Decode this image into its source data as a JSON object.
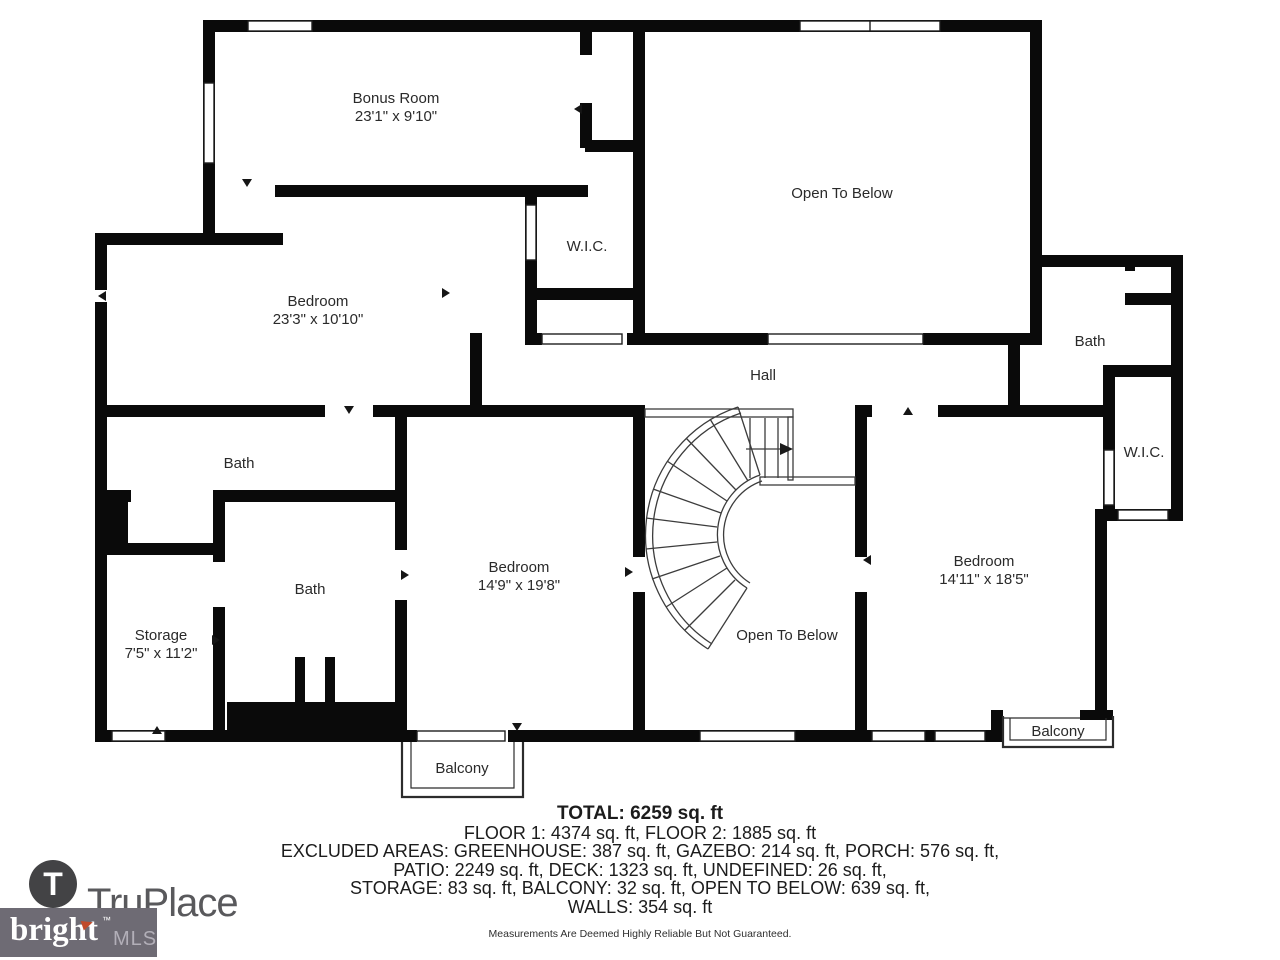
{
  "plan": {
    "rooms": [
      {
        "id": "bonus-room",
        "label": "Bonus Room",
        "dims": "23'1\" x 9'10\""
      },
      {
        "id": "open-to-below-upper",
        "label": "Open To Below",
        "dims": ""
      },
      {
        "id": "wic-upper",
        "label": "W.I.C.",
        "dims": ""
      },
      {
        "id": "bedroom-left",
        "label": "Bedroom",
        "dims": "23'3\" x 10'10\""
      },
      {
        "id": "hall",
        "label": "Hall",
        "dims": ""
      },
      {
        "id": "bath-upper-right",
        "label": "Bath",
        "dims": ""
      },
      {
        "id": "wic-right",
        "label": "W.I.C.",
        "dims": ""
      },
      {
        "id": "bath-left-upper",
        "label": "Bath",
        "dims": ""
      },
      {
        "id": "bath-left-lower",
        "label": "Bath",
        "dims": ""
      },
      {
        "id": "bedroom-middle",
        "label": "Bedroom",
        "dims": "14'9\" x 19'8\""
      },
      {
        "id": "open-to-below-lower",
        "label": "Open To Below",
        "dims": ""
      },
      {
        "id": "bedroom-right",
        "label": "Bedroom",
        "dims": "14'11\" x 18'5\""
      },
      {
        "id": "storage",
        "label": "Storage",
        "dims": "7'5\" x 11'2\""
      },
      {
        "id": "balcony-bottom",
        "label": "Balcony",
        "dims": ""
      },
      {
        "id": "balcony-right",
        "label": "Balcony",
        "dims": ""
      }
    ]
  },
  "summary": {
    "total": "TOTAL: 6259 sq. ft",
    "line2": "FLOOR 1: 4374 sq. ft, FLOOR 2: 1885 sq. ft",
    "line3": "EXCLUDED AREAS: GREENHOUSE: 387 sq. ft, GAZEBO: 214 sq. ft, PORCH: 576 sq. ft,",
    "line4": "PATIO: 2249 sq. ft, DECK: 1323 sq. ft, UNDEFINED: 26 sq. ft,",
    "line5": "STORAGE: 83 sq. ft, BALCONY: 32 sq. ft, OPEN TO BELOW: 639 sq. ft,",
    "line6": "WALLS: 354 sq. ft",
    "disclaimer": "Measurements Are Deemed Highly Reliable But Not Guaranteed."
  },
  "branding": {
    "truplace_initial": "T",
    "truplace_name": "TruPlace",
    "bright_name": "bright",
    "bright_tm": "™",
    "bright_mls": "MLS"
  },
  "colors": {
    "wall": "#0a0a0a",
    "stair_line": "#3c3c3c",
    "truplace_gray": "#59595c",
    "bright_box_gray": "#6e6b74",
    "bright_orange": "#c04a2b",
    "mls_gray": "#b2afb8"
  }
}
